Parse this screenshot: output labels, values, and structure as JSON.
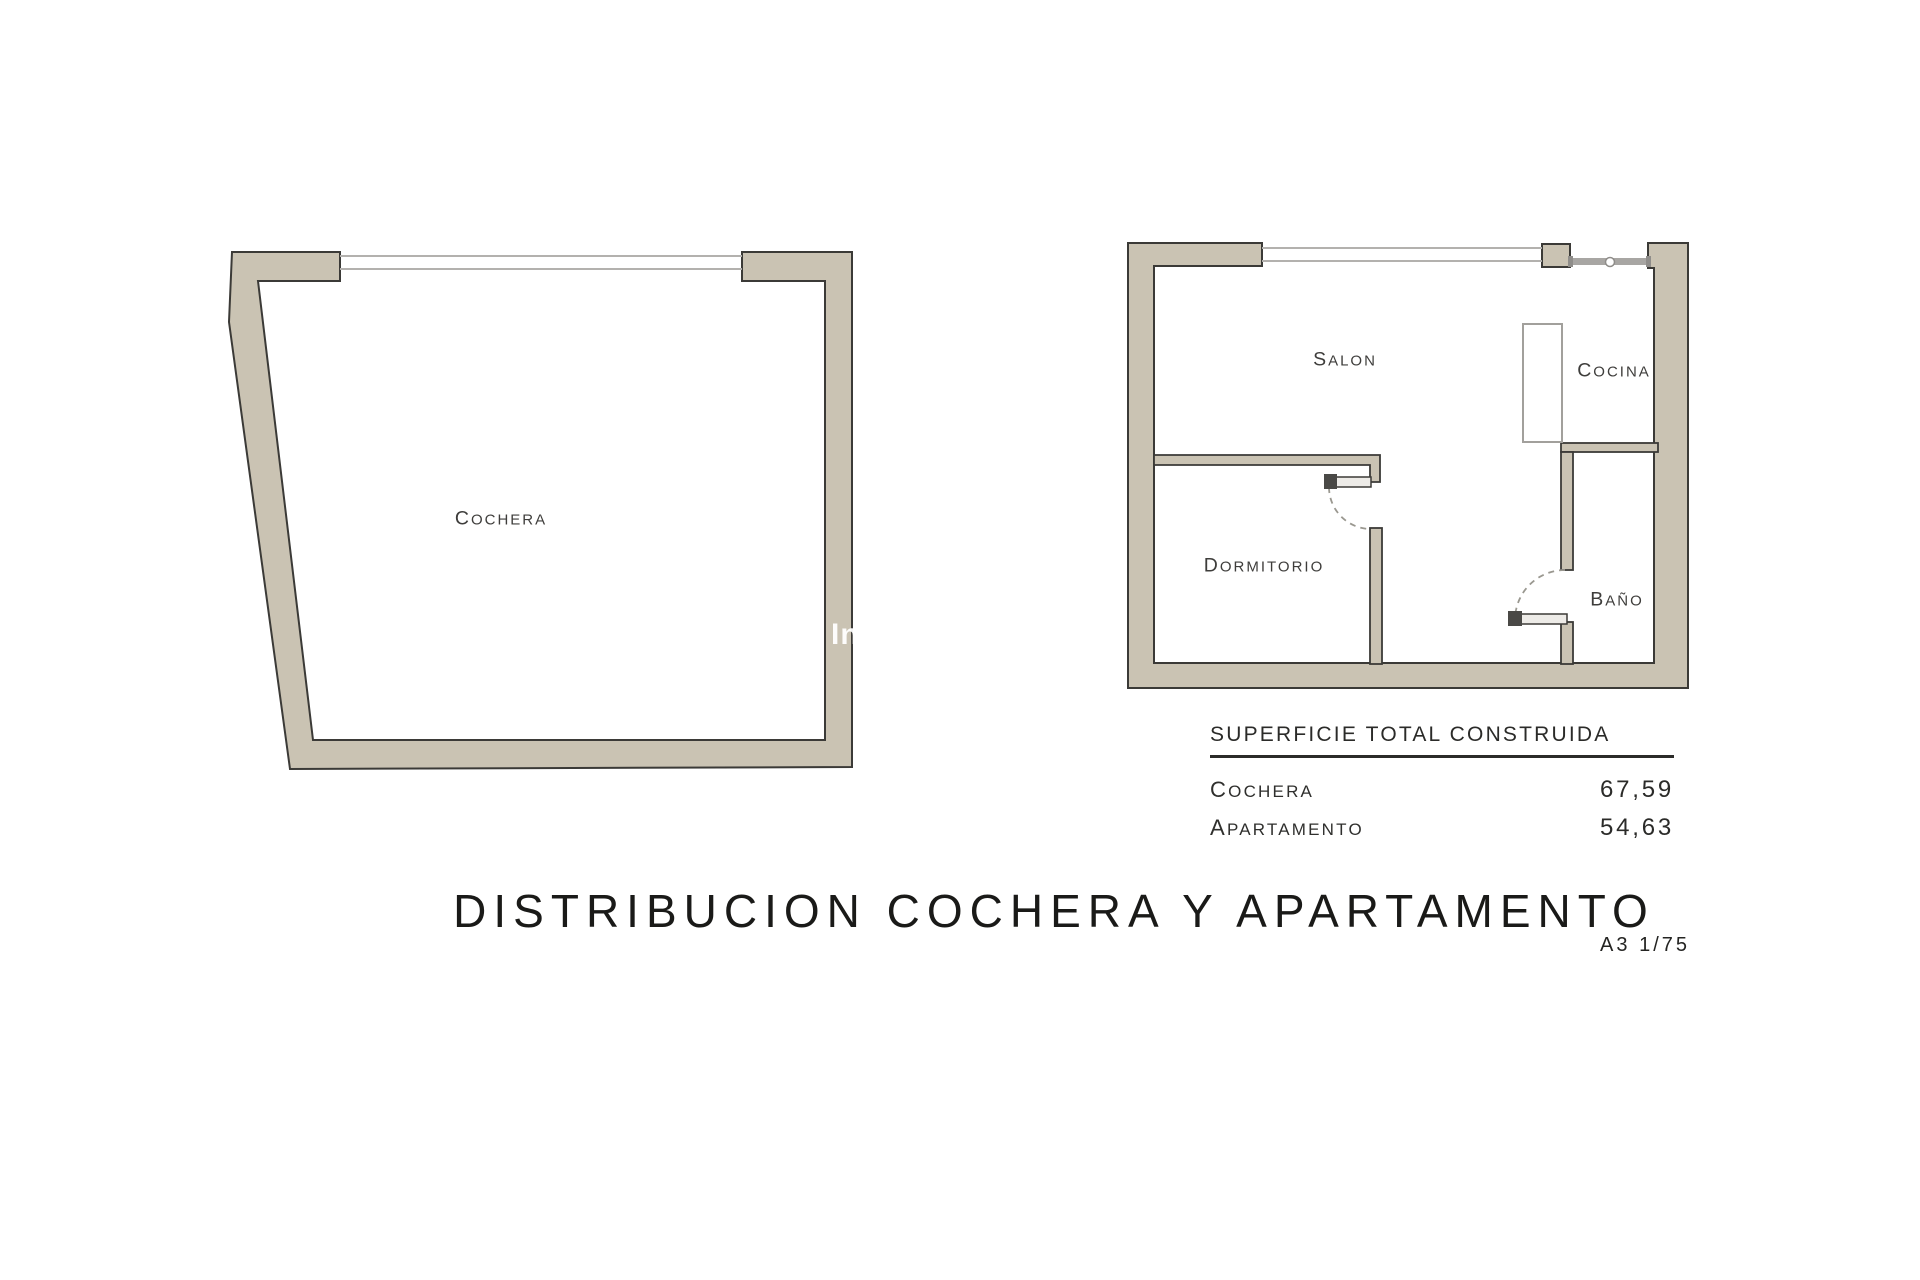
{
  "page": {
    "background": "#ffffff"
  },
  "palette": {
    "wall_fill": "#cac3b3",
    "wall_outline": "#3b3a37",
    "window_line": "#b3b1ae",
    "entry_window_bar": "#a8a6a3",
    "door_arc": "#9a9890",
    "counter_outline": "#a2a09c",
    "text_dark": "#3e3d3b",
    "title_color": "#1a1a18",
    "watermark_color": "#ffffff"
  },
  "cochera_plan": {
    "room_label": "COCHERA"
  },
  "apartment_plan": {
    "rooms": [
      {
        "id": "salon",
        "label": "SALON"
      },
      {
        "id": "cocina",
        "label": "COCINA"
      },
      {
        "id": "dormitorio",
        "label": "DORMITORIO"
      },
      {
        "id": "bano",
        "label": "BAÑO"
      }
    ]
  },
  "area_table": {
    "title": "SUPERFICIE TOTAL CONSTRUIDA",
    "rows": [
      {
        "label": "COCHERA",
        "value": "67,59"
      },
      {
        "label": "APARTAMENTO",
        "value": "54,63"
      }
    ]
  },
  "title_block": {
    "title": "DISTRIBUCION COCHERA Y APARTAMENTO",
    "sheet_scale": "A3 1/75"
  },
  "watermark": {
    "text": "In"
  }
}
